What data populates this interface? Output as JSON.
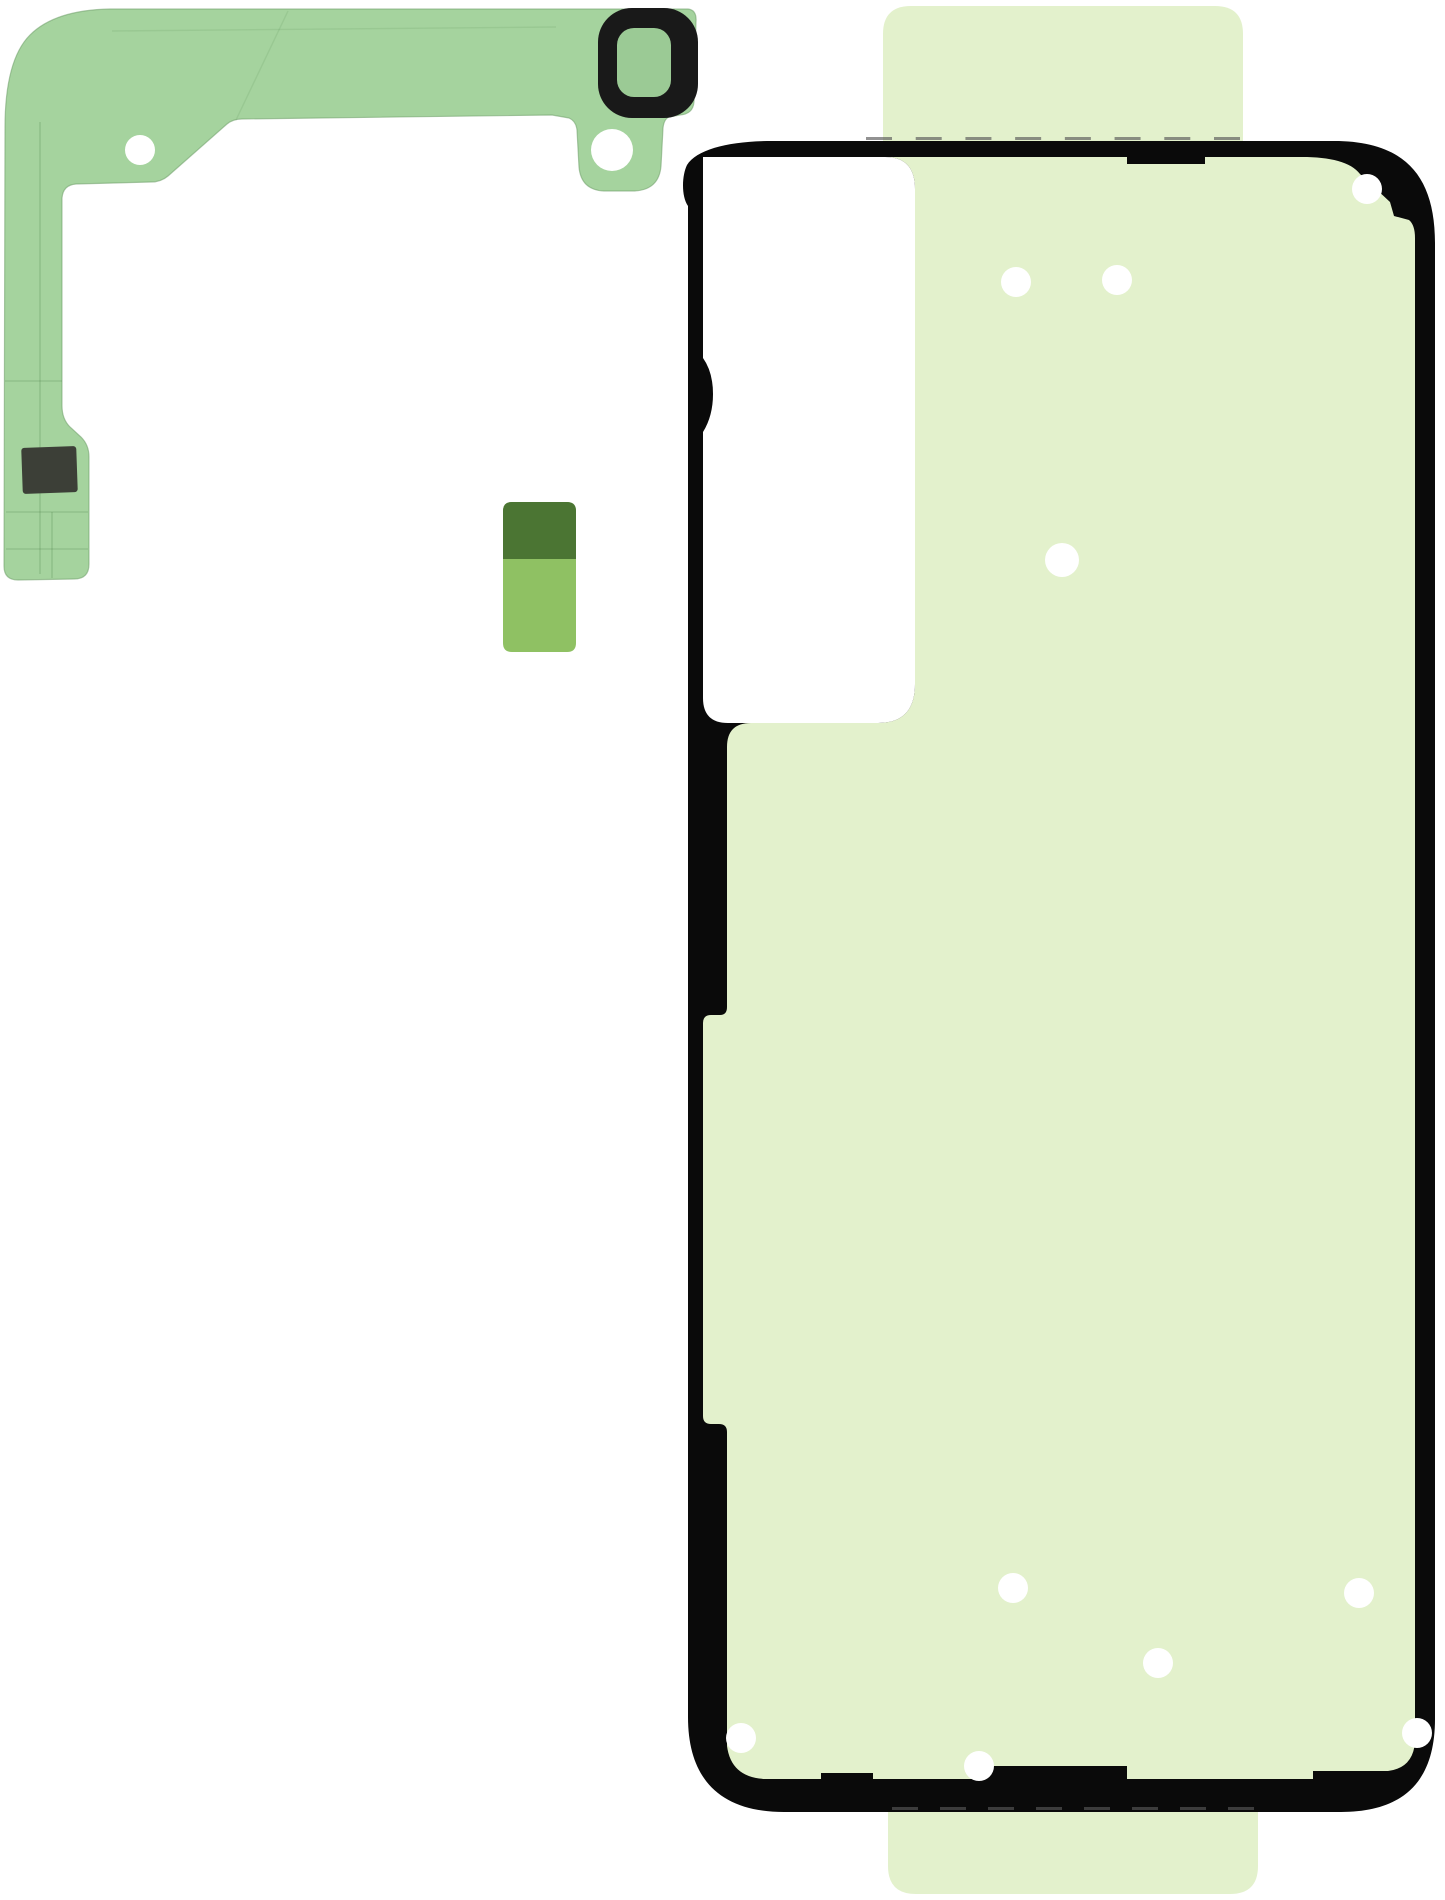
{
  "image": {
    "width": 1445,
    "height": 1900,
    "background": "#ffffff"
  },
  "colors": {
    "background": "#ffffff",
    "strip_green": "#a5d39e",
    "strip_edge": "#6f9f6a",
    "strip_crease": "#3f7a3f",
    "ring_black": "#191919",
    "ring_opening_green": "#9bca95",
    "patch_dark": "#3c3f37",
    "sticker_dark": "#4b7533",
    "sticker_light": "#8fc163",
    "liner_green": "#e3f1cc",
    "liner_edge": "#c9ddb0",
    "outline_black": "#0a0a0a",
    "dot_white": "#ffffff",
    "perforation": "#585858"
  },
  "parts": {
    "camera_frame_strip": {
      "holes": [
        {
          "cx": 140,
          "cy": 150,
          "r": 15
        },
        {
          "cx": 612,
          "cy": 150,
          "r": 21
        }
      ]
    },
    "camera_ring": {
      "outer": {
        "x": 598,
        "y": 8,
        "w": 100,
        "h": 110,
        "rx": 34
      },
      "opening": {
        "x": 617,
        "y": 28,
        "w": 54,
        "h": 69,
        "rx": 17
      }
    },
    "small_sticker": {
      "x": 503,
      "y": 502,
      "w": 73,
      "h": 150,
      "split_y": 559
    },
    "back_cover_adhesive": {
      "dots": [
        {
          "cx": 1016,
          "cy": 282,
          "r": 15
        },
        {
          "cx": 1117,
          "cy": 280,
          "r": 15
        },
        {
          "cx": 1367,
          "cy": 189,
          "r": 15
        },
        {
          "cx": 1062,
          "cy": 560,
          "r": 17
        },
        {
          "cx": 1013,
          "cy": 1588,
          "r": 15
        },
        {
          "cx": 1359,
          "cy": 1593,
          "r": 15
        },
        {
          "cx": 1158,
          "cy": 1663,
          "r": 15
        },
        {
          "cx": 741,
          "cy": 1738,
          "r": 15
        },
        {
          "cx": 979,
          "cy": 1766,
          "r": 15
        },
        {
          "cx": 1417,
          "cy": 1733,
          "r": 15
        }
      ],
      "perforations": {
        "top": {
          "y": 137,
          "x_start": 866,
          "x_end": 1240,
          "count": 8,
          "dash_w": 26,
          "dash_h": 3
        },
        "bottom": {
          "y": 1807,
          "x_start": 892,
          "x_end": 1254,
          "count": 8,
          "dash_w": 26,
          "dash_h": 3
        }
      }
    }
  }
}
